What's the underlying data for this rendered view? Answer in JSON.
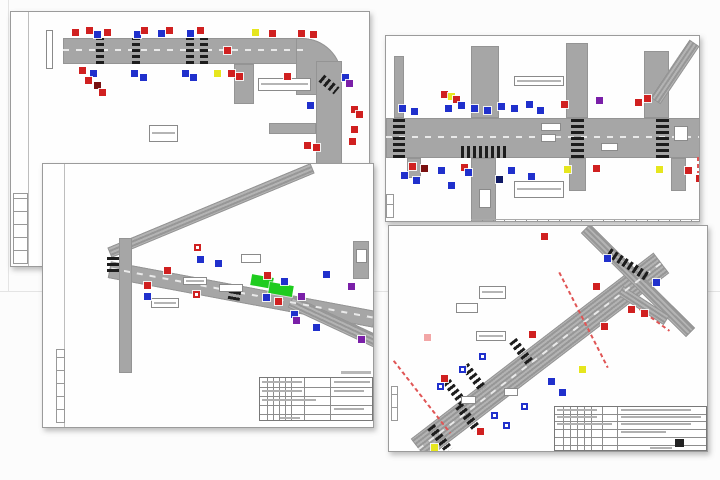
{
  "collage": {
    "name": "traffic-engineering-drawings-collage",
    "sheet_count": 4
  },
  "colors": {
    "red": "#d02020",
    "darkred": "#7a1010",
    "blue": "#2030cc",
    "navy": "#101a66",
    "purple": "#7a1fa8",
    "yellow": "#e6e61e",
    "green": "#1ecc1e",
    "pink": "#f2a6a6",
    "road": "#a6a6a6",
    "seam": "#e4e4e4"
  },
  "background": {
    "seam_vertical": {
      "x": 8,
      "y": 0,
      "h": 291
    },
    "seam_horizontal": {
      "x": 0,
      "y": 291,
      "w": 720
    }
  },
  "drawings": [
    {
      "name": "traffic-plan-sheet-top-left",
      "frame": {
        "x": 10,
        "y": 11,
        "w": 360,
        "h": 256
      },
      "vlines": [
        [
          17,
          0,
          256
        ]
      ],
      "tabs": [
        [
          2,
          181,
          15,
          71
        ]
      ],
      "roads": [
        [
          52,
          26,
          241,
          26
        ],
        [
          285,
          26,
          46,
          57,
          0,
          40
        ],
        [
          305,
          49,
          26,
          110
        ],
        [
          223,
          52,
          20,
          40
        ],
        [
          258,
          111,
          47,
          11
        ]
      ],
      "lanes": [
        [
          52,
          37,
          241,
          0
        ]
      ],
      "crosswalks": [
        [
          85,
          26,
          8,
          26
        ],
        [
          121,
          26,
          8,
          26
        ],
        [
          175,
          26,
          8,
          26
        ],
        [
          189,
          26,
          8,
          26
        ],
        [
          308,
          68,
          20,
          9,
          40,
          1
        ]
      ],
      "labels": [
        [
          247,
          66,
          53,
          13,
          1
        ],
        [
          138,
          113,
          29,
          17,
          1
        ],
        [
          35,
          18,
          7,
          39,
          0
        ]
      ],
      "signs": [
        [
          61,
          17,
          "red"
        ],
        [
          75,
          15,
          "red"
        ],
        [
          83,
          19,
          "blue"
        ],
        [
          93,
          17,
          "red"
        ],
        [
          123,
          19,
          "blue"
        ],
        [
          130,
          15,
          "red"
        ],
        [
          147,
          18,
          "blue"
        ],
        [
          155,
          15,
          "red"
        ],
        [
          176,
          18,
          "blue"
        ],
        [
          186,
          15,
          "red"
        ],
        [
          241,
          17,
          "yellow"
        ],
        [
          258,
          18,
          "red"
        ],
        [
          287,
          18,
          "red"
        ],
        [
          299,
          19,
          "red"
        ],
        [
          68,
          55,
          "red"
        ],
        [
          79,
          58,
          "blue"
        ],
        [
          74,
          65,
          "red"
        ],
        [
          83,
          70,
          "darkred"
        ],
        [
          88,
          77,
          "red"
        ],
        [
          120,
          58,
          "blue"
        ],
        [
          129,
          62,
          "blue"
        ],
        [
          171,
          58,
          "blue"
        ],
        [
          179,
          62,
          "blue"
        ],
        [
          203,
          58,
          "yellow"
        ],
        [
          217,
          58,
          "red"
        ],
        [
          225,
          61,
          "red"
        ],
        [
          273,
          61,
          "red"
        ],
        [
          296,
          90,
          "blue"
        ],
        [
          331,
          62,
          "blue"
        ],
        [
          335,
          68,
          "purple"
        ],
        [
          340,
          94,
          "red"
        ],
        [
          345,
          99,
          "red"
        ],
        [
          340,
          114,
          "red"
        ],
        [
          293,
          130,
          "red"
        ],
        [
          302,
          132,
          "red"
        ],
        [
          338,
          126,
          "red"
        ],
        [
          213,
          35,
          "red"
        ]
      ]
    },
    {
      "name": "traffic-plan-sheet-top-right",
      "frame": {
        "x": 385,
        "y": 35,
        "w": 315,
        "h": 187
      },
      "tabs": [
        [
          0,
          158,
          8,
          24
        ]
      ],
      "roads": [
        [
          0,
          82,
          315,
          40
        ],
        [
          8,
          20,
          10,
          62
        ],
        [
          85,
          10,
          28,
          72
        ],
        [
          180,
          7,
          22,
          75
        ],
        [
          258,
          15,
          25,
          67
        ],
        [
          254,
          30,
          70,
          12,
          -56,
          0,
          1
        ],
        [
          85,
          122,
          25,
          65
        ],
        [
          183,
          122,
          17,
          33
        ],
        [
          285,
          122,
          15,
          33
        ],
        [
          21,
          122,
          14,
          20
        ]
      ],
      "lanes": [
        [
          0,
          100,
          315,
          0
        ]
      ],
      "crosswalks": [
        [
          7,
          82,
          12,
          40
        ],
        [
          185,
          82,
          13,
          40
        ],
        [
          270,
          82,
          13,
          40
        ],
        [
          75,
          110,
          48,
          12,
          0,
          1
        ]
      ],
      "labels": [
        [
          128,
          40,
          50,
          10,
          1
        ],
        [
          128,
          145,
          50,
          17,
          1
        ],
        [
          215,
          107,
          17,
          8,
          0
        ],
        [
          288,
          90,
          14,
          15,
          0
        ],
        [
          155,
          87,
          20,
          8,
          0
        ],
        [
          155,
          98,
          15,
          8,
          0
        ],
        [
          93,
          153,
          12,
          19,
          0
        ]
      ],
      "redlines": [
        [
          307,
          32,
          30,
          90
        ],
        [
          304,
          128,
          16,
          90
        ],
        [
          310,
          156,
          12,
          90
        ]
      ],
      "ticks": [
        [
          85,
          183,
          230
        ]
      ],
      "signs": [
        [
          13,
          69,
          "blue"
        ],
        [
          25,
          72,
          "blue"
        ],
        [
          55,
          55,
          "red"
        ],
        [
          62,
          57,
          "yellow"
        ],
        [
          67,
          60,
          "red"
        ],
        [
          59,
          69,
          "blue"
        ],
        [
          72,
          66,
          "blue"
        ],
        [
          85,
          69,
          "blue"
        ],
        [
          98,
          71,
          "blue"
        ],
        [
          112,
          67,
          "blue"
        ],
        [
          125,
          69,
          "blue"
        ],
        [
          140,
          65,
          "blue"
        ],
        [
          151,
          71,
          "blue"
        ],
        [
          175,
          65,
          "red"
        ],
        [
          210,
          61,
          "purple"
        ],
        [
          249,
          63,
          "red"
        ],
        [
          258,
          59,
          "red"
        ],
        [
          23,
          127,
          "red"
        ],
        [
          35,
          129,
          "darkred"
        ],
        [
          15,
          136,
          "blue"
        ],
        [
          27,
          141,
          "blue"
        ],
        [
          52,
          131,
          "blue"
        ],
        [
          62,
          146,
          "blue"
        ],
        [
          75,
          128,
          "red"
        ],
        [
          79,
          133,
          "blue"
        ],
        [
          110,
          140,
          "navy"
        ],
        [
          122,
          131,
          "blue"
        ],
        [
          142,
          137,
          "blue"
        ],
        [
          178,
          130,
          "yellow"
        ],
        [
          207,
          129,
          "red"
        ],
        [
          270,
          130,
          "yellow"
        ],
        [
          299,
          131,
          "red"
        ],
        [
          310,
          139,
          "red"
        ]
      ]
    },
    {
      "name": "traffic-plan-sheet-bottom-left",
      "frame": {
        "x": 42,
        "y": 163,
        "w": 332,
        "h": 265
      },
      "vlines": [
        [
          21,
          0,
          265
        ]
      ],
      "tabs": [
        [
          13,
          185,
          9,
          74
        ]
      ],
      "roads": [
        [
          58,
          41,
          220,
          11,
          -22.6,
          0,
          1
        ],
        [
          64,
          122,
          270,
          17,
          10.6
        ],
        [
          243,
          151,
          95,
          13,
          25,
          0,
          1
        ],
        [
          76,
          74,
          13,
          135
        ],
        [
          310,
          77,
          16,
          38
        ]
      ],
      "lanes": [
        [
          66,
          128,
          266,
          10.6
        ]
      ],
      "crosswalks": [
        [
          186,
          120,
          12,
          16,
          10
        ],
        [
          64,
          92,
          12,
          16
        ]
      ],
      "greens": [
        [
          208,
          112,
          22,
          11,
          10
        ],
        [
          226,
          120,
          24,
          11,
          10
        ]
      ],
      "labels": [
        [
          140,
          113,
          24,
          8,
          1
        ],
        [
          176,
          120,
          24,
          8,
          0
        ],
        [
          108,
          134,
          28,
          10,
          1
        ],
        [
          198,
          90,
          20,
          9,
          0
        ],
        [
          313,
          85,
          11,
          14,
          0
        ]
      ],
      "smudges": [
        [
          298,
          207,
          30
        ]
      ],
      "titleblock": {
        "x": 216,
        "y": 213,
        "w": 114,
        "h": 44,
        "v": [
          7,
          13,
          19,
          25,
          31,
          44,
          70
        ],
        "h2": [
          9,
          18,
          27,
          36
        ],
        "s": [
          [
            2,
            3,
            40
          ],
          [
            2,
            12,
            40
          ],
          [
            2,
            21,
            54
          ],
          [
            74,
            3,
            36
          ],
          [
            74,
            12,
            30
          ],
          [
            74,
            30,
            30
          ],
          [
            20,
            39,
            20
          ]
        ],
        "b": null
      },
      "signs": [
        [
          151,
          80,
          "red",
          1
        ],
        [
          154,
          92,
          "blue"
        ],
        [
          172,
          96,
          "blue"
        ],
        [
          101,
          118,
          "red"
        ],
        [
          101,
          129,
          "blue"
        ],
        [
          150,
          127,
          "red",
          1
        ],
        [
          121,
          103,
          "red"
        ],
        [
          221,
          108,
          "red"
        ],
        [
          238,
          114,
          "blue"
        ],
        [
          220,
          130,
          "blue"
        ],
        [
          232,
          134,
          "red"
        ],
        [
          255,
          129,
          "purple"
        ],
        [
          280,
          107,
          "blue"
        ],
        [
          305,
          119,
          "purple"
        ],
        [
          248,
          147,
          "blue"
        ],
        [
          250,
          153,
          "purple"
        ],
        [
          270,
          160,
          "blue"
        ],
        [
          315,
          172,
          "purple"
        ]
      ]
    },
    {
      "name": "traffic-plan-sheet-bottom-right",
      "frame": {
        "x": 388,
        "y": 225,
        "w": 320,
        "h": 227
      },
      "tabs": [
        [
          2,
          160,
          7,
          35
        ]
      ],
      "roads": [
        [
          -2,
          117,
          306,
          26,
          -37.5,
          0,
          1
        ],
        [
          175,
          48,
          148,
          13,
          44.7,
          0,
          1
        ],
        [
          227,
          74,
          55,
          11,
          33,
          0,
          1
        ]
      ],
      "lanes": [
        [
          -2,
          129,
          306,
          -37.5
        ]
      ],
      "crosswalks": [
        [
          216,
          34,
          46,
          9,
          33,
          1
        ],
        [
          118,
          122,
          30,
          9,
          52,
          1
        ],
        [
          70,
          147,
          30,
          9,
          52,
          1
        ],
        [
          52,
          163,
          30,
          9,
          52,
          1
        ],
        [
          64,
          187,
          30,
          9,
          52,
          1
        ],
        [
          36,
          208,
          30,
          9,
          52,
          1
        ]
      ],
      "redlines": [
        [
          -13,
          170,
          92,
          52
        ],
        [
          141,
          93,
          107,
          63
        ],
        [
          247,
          93,
          37,
          36
        ]
      ],
      "labels": [
        [
          87,
          105,
          30,
          10,
          1
        ],
        [
          115,
          162,
          14,
          8,
          0
        ],
        [
          72,
          170,
          15,
          8,
          0
        ],
        [
          90,
          60,
          27,
          13,
          1
        ],
        [
          67,
          77,
          22,
          10,
          0
        ]
      ],
      "titleblock": {
        "x": 165,
        "y": 180,
        "w": 153,
        "h": 45,
        "v": [
          8,
          15,
          22,
          29,
          36,
          47,
          62
        ],
        "h2": [
          7,
          14,
          22,
          30,
          38
        ],
        "s": [
          [
            2,
            2,
            40
          ],
          [
            2,
            9,
            40
          ],
          [
            2,
            16,
            55
          ],
          [
            66,
            2,
            70
          ],
          [
            66,
            9,
            80
          ],
          [
            66,
            16,
            70
          ],
          [
            66,
            24,
            45
          ],
          [
            95,
            40,
            22
          ]
        ],
        "b": [
          120,
          32,
          9,
          8
        ]
      },
      "signs": [
        [
          215,
          29,
          "blue"
        ],
        [
          264,
          53,
          "blue"
        ],
        [
          204,
          57,
          "red"
        ],
        [
          152,
          7,
          "red"
        ],
        [
          140,
          105,
          "red"
        ],
        [
          190,
          140,
          "yellow"
        ],
        [
          212,
          97,
          "red"
        ],
        [
          239,
          80,
          "red"
        ],
        [
          252,
          84,
          "red"
        ],
        [
          159,
          152,
          "blue"
        ],
        [
          170,
          163,
          "blue"
        ],
        [
          90,
          127,
          "blue",
          1
        ],
        [
          52,
          149,
          "red"
        ],
        [
          70,
          140,
          "blue",
          1
        ],
        [
          48,
          157,
          "blue",
          1
        ],
        [
          102,
          186,
          "blue",
          1
        ],
        [
          114,
          196,
          "blue",
          1
        ],
        [
          132,
          177,
          "blue",
          1
        ],
        [
          88,
          202,
          "red"
        ],
        [
          42,
          218,
          "yellow"
        ],
        [
          35,
          108,
          "pink"
        ]
      ]
    }
  ]
}
